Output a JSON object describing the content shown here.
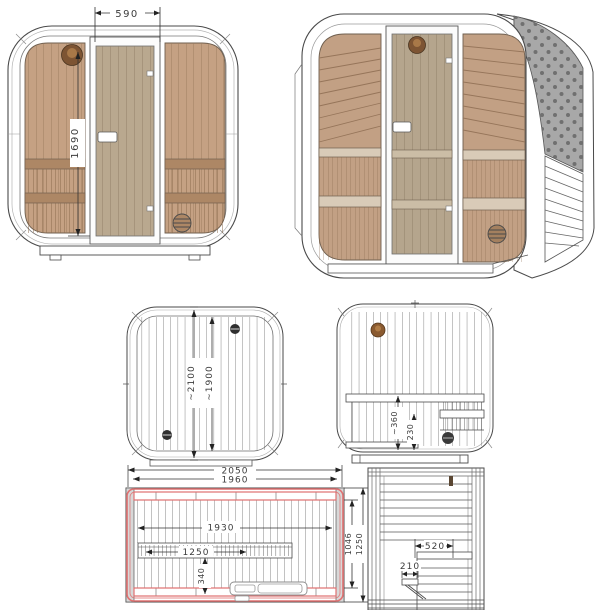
{
  "document": {
    "type": "sauna-cube-technical-drawing",
    "background": "#ffffff"
  },
  "colors": {
    "outline": "#4a4a4a",
    "light_outline": "#9a9a9a",
    "wood": "#c5a183",
    "wood_dark": "#ad8765",
    "door_glass": "#b9a88f",
    "plank_line": "#9a7a5c",
    "shingle": "#a8a8a8",
    "shingle_dot": "#707070",
    "highlight_red": "#e07070",
    "sauna_light_brown": "#7d5433",
    "vent_dark": "#3a3a3a",
    "dim_text": "#3c3c3c"
  },
  "views": {
    "front_elevation": {
      "name": "front elevation",
      "dims": {
        "door_width": "590",
        "door_height": "1690"
      }
    },
    "perspective": {
      "name": "3d perspective"
    },
    "top_plan": {
      "name": "roof plan",
      "dims": {
        "outer_depth": "~2100",
        "inner_depth": "~1900"
      }
    },
    "rear_elevation": {
      "name": "rear interior elevation",
      "dims": {
        "bench_height": "~360",
        "ledge_height": "230"
      }
    },
    "floor_plan": {
      "name": "floor plan",
      "dims": {
        "overall_width": "2050",
        "frame_width": "1960",
        "interior_width": "1930",
        "bench_length": "1250",
        "heater_gap": "340",
        "interior_depth": "1046",
        "overall_depth": "1250"
      }
    },
    "side_elevation": {
      "name": "side interior elevation",
      "dims": {
        "bench_depth": "520",
        "step_depth": "210"
      }
    }
  }
}
